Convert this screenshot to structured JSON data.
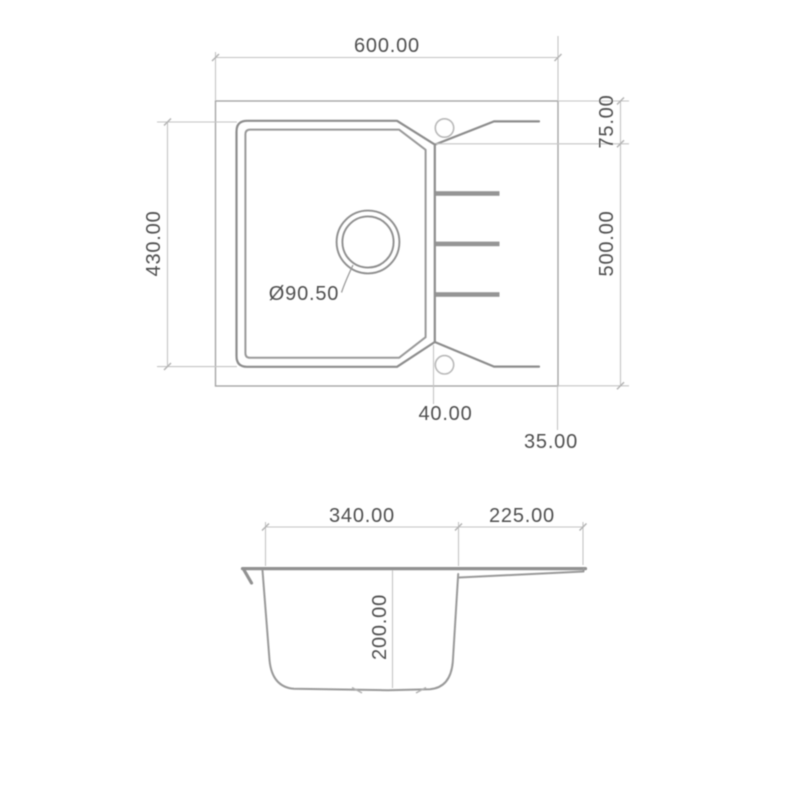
{
  "drawing": {
    "type": "technical-drawing",
    "subject": "Kitchen sink with drainboard - top view and cross-section",
    "colors": {
      "background": "#ffffff",
      "contour_gray": "#8d8d8d",
      "dimension_gray": "#c4c4c4",
      "label_text": "#4f4f4f"
    },
    "top_view": {
      "overall_width": "600.00",
      "overall_depth": "500.00",
      "rim_depth": "430.00",
      "drainer_ledge": "75.00",
      "tap_hole_offset": "40.00",
      "edge_offset": "35.00",
      "drain_diameter": "Ø90.50"
    },
    "section_view": {
      "bowl_width": "340.00",
      "drainer_width": "225.00",
      "bowl_depth": "200.00"
    }
  }
}
